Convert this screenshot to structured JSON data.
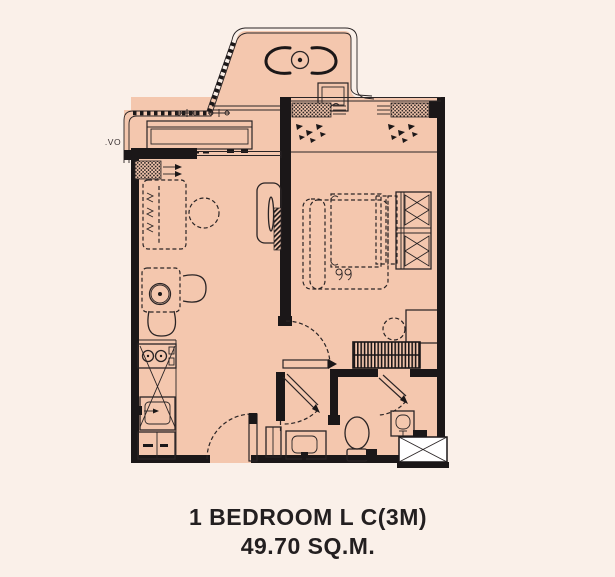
{
  "canvas": {
    "width": 615,
    "height": 577,
    "background": "#faf0e9"
  },
  "palette": {
    "floor": "#f4c7ae",
    "wall": "#1b1718",
    "line": "#2a2425",
    "shaft_white": "#ffffff",
    "text": "#231f20"
  },
  "caption": {
    "line1": "1 BEDROOM L C(3M)",
    "line2": "49.70 SQ.M."
  },
  "labels": {
    "ac_ledge": ".VO"
  },
  "furniture": [
    "balcony-lounge-chair-left",
    "balcony-round-table",
    "balcony-lounge-chair-right",
    "condensing-unit",
    "rooftop-ac-box",
    "fan-coil-unit",
    "sofa",
    "rug-circle",
    "tv-console",
    "wall-tv",
    "dining-table",
    "ceiling-fan",
    "dining-chair-right",
    "dining-chair-bottom",
    "stove",
    "kitchen-counter",
    "kitchen-sink",
    "fridge",
    "entry-door",
    "bedroom-door",
    "bathroom-door",
    "shower-door",
    "bed-platform",
    "mattress",
    "pillows",
    "slippers",
    "wardrobe",
    "bedroom-dresser",
    "striped-drawer-unit",
    "stool",
    "corner-desk",
    "toilet",
    "vanity-sink",
    "vanity-cabinet",
    "wash-basin",
    "service-shaft",
    "window-hatch",
    "curtain-marks"
  ]
}
